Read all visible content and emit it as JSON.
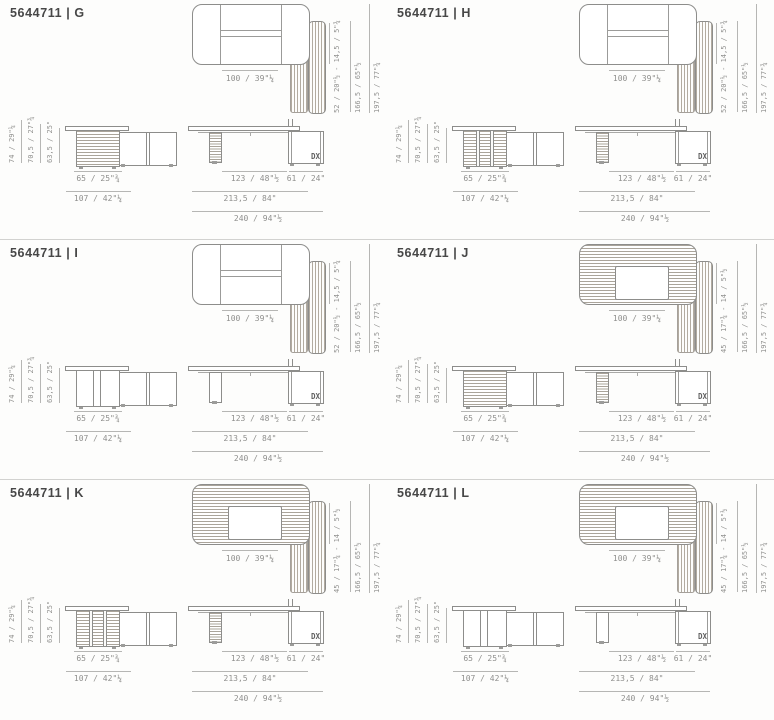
{
  "shared": {
    "top_width": "100 / 39\"¼",
    "side_h2": "166,5 / 65\"½",
    "side_h3": "197,5 / 77\"¾",
    "cab_h1": "74 / 29\"¼",
    "cab_h2": "70,5 / 27\"¾",
    "cab_h3": "63,5 / 25\"",
    "cab_w1": "65 / 25\"¾",
    "cab_w2": "107 / 42\"¼",
    "desk_w1": "123 / 48\"½",
    "desk_w2": "61 / 24\"",
    "desk_w3": "213,5 / 84\"",
    "desk_w4": "240 / 94\"½",
    "dx": "DX"
  },
  "panels": [
    {
      "title": "5644711 | G",
      "variant": "G",
      "side_h1": "52 / 20\"½ - 14,5 / 5\"¾",
      "top_style": "plain",
      "cabinet_style": "hatched",
      "leg_style": "hatched"
    },
    {
      "title": "5644711 | H",
      "variant": "H",
      "side_h1": "52 / 20\"½ - 14,5 / 5\"¾",
      "top_style": "plain",
      "cabinet_style": "divided",
      "leg_style": "hatched"
    },
    {
      "title": "5644711 | I",
      "variant": "I",
      "side_h1": "52 / 20\"½ - 14,5 / 5\"¾",
      "top_style": "plain",
      "cabinet_style": "plain",
      "leg_style": "plain"
    },
    {
      "title": "5644711 | J",
      "variant": "J",
      "side_h1": "45 / 17\"¾ - 14 / 5\"½",
      "top_style": "hatched",
      "cabinet_style": "hatched",
      "leg_style": "hatched"
    },
    {
      "title": "5644711 | K",
      "variant": "K",
      "side_h1": "45 / 17\"¾ - 14 / 5\"½",
      "top_style": "hatched",
      "cabinet_style": "divided",
      "leg_style": "hatched"
    },
    {
      "title": "5644711 | L",
      "variant": "L",
      "side_h1": "45 / 17\"¾ - 14 / 5\"½",
      "top_style": "hatched",
      "cabinet_style": "plain",
      "leg_style": "plain"
    }
  ]
}
